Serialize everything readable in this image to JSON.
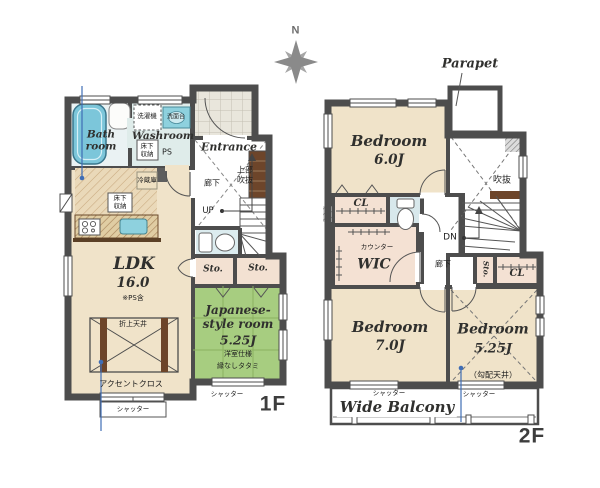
{
  "compass": {
    "north": "N"
  },
  "floor1": {
    "caption": "1F",
    "rooms": {
      "bath": "Bath\nroom",
      "washroom": "Washroom",
      "entrance": "Entrance",
      "ldk": {
        "name": "LDK",
        "size": "16.0",
        "note": "※PS含"
      },
      "jroom": {
        "name": "Japanese-\nstyle room",
        "size": "5.25J",
        "spec1": "洋室仕様",
        "spec2": "縁なしタタミ"
      },
      "sto1": "Sto.",
      "sto2": "Sto."
    },
    "labels": {
      "washer": "洗濯機",
      "vanity": "洗面台",
      "floor_storage1": "床下\n収納",
      "ps": "PS",
      "hall": "廊下",
      "upper_void": "上部\n吹抜",
      "up": "UP",
      "fridge": "冷蔵庫",
      "floor_storage2": "床下\n収納",
      "coffered_ceiling": "折上天井",
      "accent_cloth": "アクセントクロス",
      "shutter1": "シャッター",
      "shutter2": "シャッター"
    }
  },
  "floor2": {
    "caption": "2F",
    "parapet": "Parapet",
    "rooms": {
      "bedroom6": {
        "name": "Bedroom",
        "size": "6.0J"
      },
      "bedroom7": {
        "name": "Bedroom",
        "size": "7.0J"
      },
      "bedroom525": {
        "name": "Bedroom",
        "size": "5.25J",
        "note": "（勾配天井）"
      },
      "wic": "WIC",
      "cl1": "CL",
      "cl2": "CL",
      "sto": "Sto.",
      "balcony": "Wide Balcony"
    },
    "labels": {
      "void": "吹抜",
      "counter": "カウンター",
      "dn": "DN",
      "hall": "廊下",
      "shutter1": "シャッター",
      "shutter2": "シャッター"
    }
  },
  "colors": {
    "wall": "#4d4d4d",
    "floor": "#f0e3c9",
    "tatami": "#a7cd80",
    "water": "#7cc6da",
    "wood": "#6d452a",
    "closet": "#f4e1d3",
    "leader_blue": "#3f6db5"
  }
}
